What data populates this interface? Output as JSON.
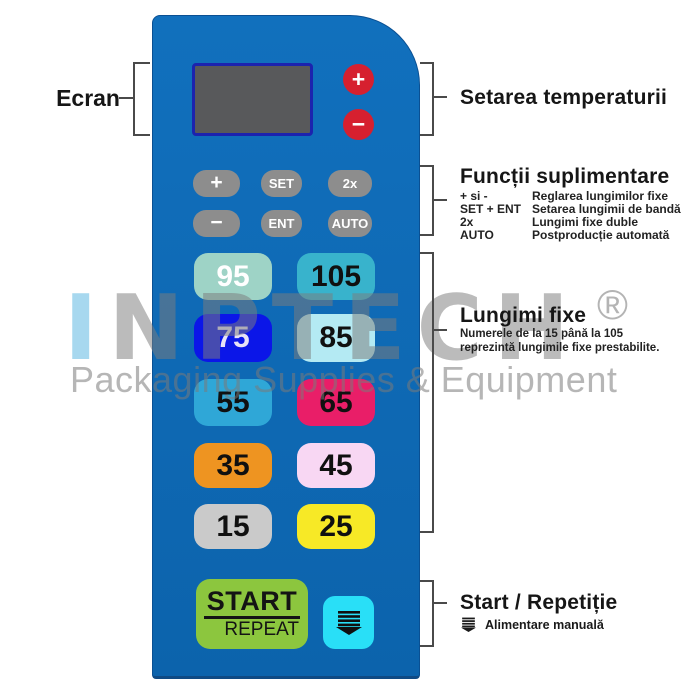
{
  "panel": {
    "screen_name": "display",
    "temp_plus": "+",
    "temp_minus": "−",
    "fn_buttons": [
      {
        "label": "+"
      },
      {
        "label": "SET"
      },
      {
        "label": "2x"
      },
      {
        "label": "−"
      },
      {
        "label": "ENT"
      },
      {
        "label": "AUTO"
      }
    ],
    "length_buttons": [
      {
        "label": "95",
        "bg": "#9ed3c6",
        "fg": "#ffffff"
      },
      {
        "label": "105",
        "bg": "#38b3cc",
        "fg": "#101010"
      },
      {
        "label": "75",
        "bg": "#0b16e8",
        "fg": "#e6e2f6"
      },
      {
        "label": "85",
        "bg": "#b4eaf3",
        "fg": "#101010"
      },
      {
        "label": "55",
        "bg": "#2fa7d7",
        "fg": "#101010"
      },
      {
        "label": "65",
        "bg": "#e91e68",
        "fg": "#101010"
      },
      {
        "label": "35",
        "bg": "#ee9421",
        "fg": "#101010"
      },
      {
        "label": "45",
        "bg": "#f8d7f3",
        "fg": "#101010"
      },
      {
        "label": "15",
        "bg": "#cacaca",
        "fg": "#101010"
      },
      {
        "label": "25",
        "bg": "#f7e926",
        "fg": "#101010"
      }
    ],
    "start_button": {
      "line1": "START",
      "line2": "REPEAT"
    }
  },
  "annotations": {
    "ecran": {
      "label": "Ecran"
    },
    "temperature": {
      "label": "Setarea temperaturii"
    },
    "functions": {
      "title": "Funcții suplimentare",
      "rows": [
        {
          "key": "+ si -",
          "desc": "Reglarea lungimilor fixe"
        },
        {
          "key": "SET + ENT",
          "desc": "Setarea lungimii de bandă"
        },
        {
          "key": "2x",
          "desc": "Lungimi fixe duble"
        },
        {
          "key": "AUTO",
          "desc": "Postproducție automată"
        }
      ]
    },
    "lengths": {
      "title": "Lungimi fixe",
      "note_line1": "Numerele de la 15 până la 105",
      "note_line2": "reprezintă lungimile fixe prestabilite."
    },
    "start": {
      "title": "Start / Repetiție",
      "note": "Alimentare manuală"
    }
  },
  "watermark": {
    "logo_first": "I",
    "logo_rest": "NPTECH",
    "reg": "®",
    "tagline": "Packaging Supplies & Equipment"
  },
  "colors": {
    "panel_blue": "#0d68b2",
    "temp_button_red": "#d6202f",
    "fn_button_gray": "#8d8d8d",
    "start_green": "#8cc63e",
    "feed_cyan": "#29dff7",
    "screen_gray": "#58595b",
    "screen_border_blue": "#1c23ae"
  }
}
